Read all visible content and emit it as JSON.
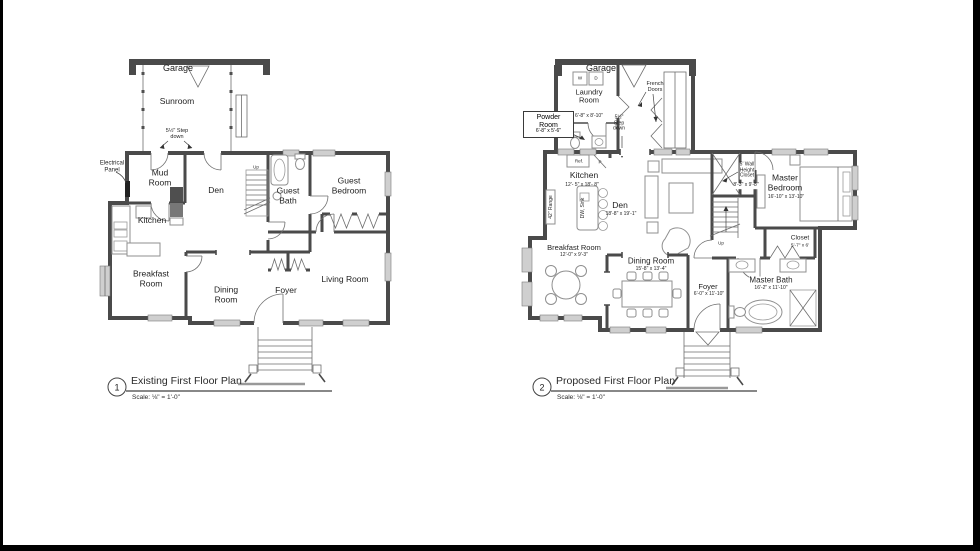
{
  "colors": {
    "wall": "#4a4a4a",
    "window": "#cfcfcf",
    "furniture": "#8f8f8f",
    "text": "#1f1f1f",
    "border": "#000000"
  },
  "plans": {
    "existing": {
      "number": "1",
      "title": "Existing First Floor Plan",
      "scale": "Scale: ⅛\" = 1'-0\"",
      "labels": {
        "garage": "Garage",
        "sunroom": "Sunroom",
        "step_down": "5½\" Step\ndown",
        "electrical_panel": "Electrical\nPanel",
        "mud_room": "Mud\nRoom",
        "den": "Den",
        "kitchen": "Kitchen",
        "guest_bath": "Guest\nBath",
        "guest_bedroom": "Guest\nBedroom",
        "breakfast_room": "Breakfast\nRoom",
        "dining_room": "Dining\nRoom",
        "foyer": "Foyer",
        "living_room": "Living Room",
        "up": "Up"
      }
    },
    "proposed": {
      "number": "2",
      "title": "Proposed First Floor Plan",
      "scale": "Scale: ⅛\" = 1'-0\"",
      "labels": {
        "garage": "Garage",
        "washer": "W",
        "dryer": "D",
        "laundry_room": "Laundry\nRoom",
        "laundry_room_dim": "6'-8\" x 8'-10\"",
        "french_doors": "French\nDoors",
        "powder_room": "Powder\nRoom",
        "powder_room_dim": "6'-8\" x 5'-6\"",
        "step_down": "5½\"\nStep\ndown",
        "refrigerator": "Ref.",
        "pantry": "P",
        "kitchen": "Kitchen",
        "kitchen_dim": "12'- 5\" x 18'- 8\"",
        "range": "42\" Range",
        "dw_sink": "DW, Sink",
        "den": "Den",
        "den_dim": "18'-8\" x 19'-1\"",
        "wall_height_closet": "5' Wall\nHeight\nCloset",
        "wall_height_closet_dim": "8'-3\" x 9'-8\"",
        "master_bedroom": "Master\nBedroom",
        "master_bedroom_dim": "16'-10\" x 13'-10\"",
        "closet": "Closet",
        "closet_dim": "5'-7\" x 6'",
        "master_bath": "Master Bath",
        "master_bath_dim": "16'-2\" x 11'-10\"",
        "breakfast_room": "Breakfast Room",
        "breakfast_room_dim": "12'-0\" x 9'-3\"",
        "dining_room": "Dining Room",
        "dining_room_dim": "15'-8\" x 13'-4\"",
        "foyer": "Foyer",
        "foyer_dim": "6'-0\" x 11'-10\"",
        "up": "Up"
      }
    }
  }
}
